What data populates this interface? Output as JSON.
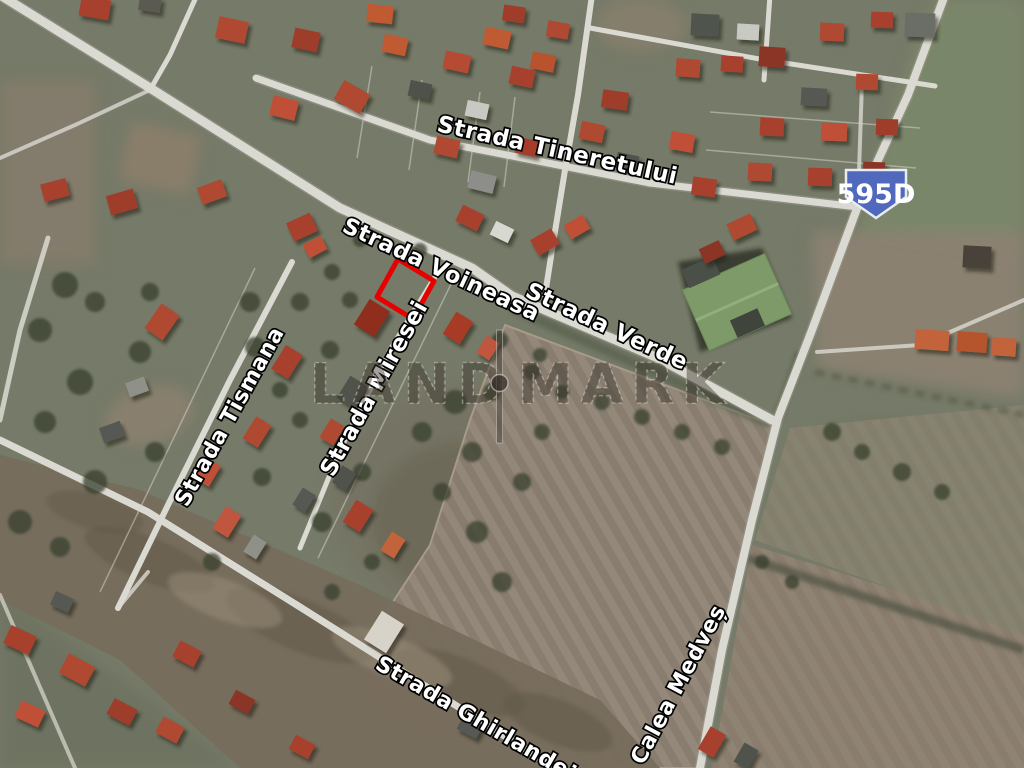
{
  "image": {
    "kind": "satellite-aerial-photo",
    "width": 1024,
    "height": 768
  },
  "watermark": {
    "left": "LAND",
    "right": "MARK",
    "divider": "bar-dot-separator"
  },
  "road_badge": {
    "label": "595D",
    "fill": "#5069bd"
  },
  "plot_marker": {
    "shape": "rotated-rectangle",
    "color": "#e60000"
  },
  "street_labels": [
    {
      "id": "tineretului",
      "text": "Strada Tineretului",
      "x": 436,
      "y": 131,
      "rot": 12.5,
      "size": 23
    },
    {
      "id": "voineasa",
      "text": "Strada Voineasa",
      "x": 341,
      "y": 231,
      "rot": 25,
      "size": 22.5
    },
    {
      "id": "verde",
      "text": "Strada Verde",
      "x": 524,
      "y": 296,
      "rot": 25,
      "size": 23
    },
    {
      "id": "tismana",
      "text": "Strada Tismana",
      "x": 187,
      "y": 508,
      "rot": -61,
      "size": 22
    },
    {
      "id": "miresei",
      "text": "Strada Miresei",
      "x": 333,
      "y": 478,
      "rot": -61,
      "size": 23
    },
    {
      "id": "ghirlandei",
      "text": "Strada Ghirlandei",
      "x": 374,
      "y": 668,
      "rot": 30,
      "size": 22
    },
    {
      "id": "calea-medves",
      "text": "Calea Medveș",
      "x": 643,
      "y": 766,
      "rot": -62,
      "size": 22
    }
  ],
  "colors": {
    "terrain": "#767a68",
    "road": "#dbdad2",
    "road_edge": "#9c9c90",
    "field": "#8e8276",
    "field_stripe": "#958a7c",
    "scrub": "#776d5d",
    "roof_red": "#a8412e",
    "roof_orange": "#c2633a",
    "roof_dark": "#4f524c",
    "warehouse_green": "#7e9a68",
    "label_text": "#ffffff",
    "plot_outline": "#e60000",
    "badge_blue": "#5069bd"
  },
  "houses": [
    [
      95,
      8,
      30,
      20,
      10,
      "#a8412e"
    ],
    [
      150,
      4,
      22,
      15,
      8,
      "#5a5a52"
    ],
    [
      232,
      30,
      30,
      22,
      12,
      "#b04a30"
    ],
    [
      306,
      40,
      26,
      20,
      12,
      "#9e3d2a"
    ],
    [
      380,
      14,
      26,
      18,
      6,
      "#c05a33"
    ],
    [
      352,
      97,
      30,
      22,
      30,
      "#b04a30"
    ],
    [
      284,
      108,
      26,
      20,
      14,
      "#c05038"
    ],
    [
      420,
      90,
      22,
      16,
      12,
      "#50514b"
    ],
    [
      457,
      62,
      26,
      18,
      12,
      "#b44c32"
    ],
    [
      522,
      77,
      24,
      18,
      12,
      "#a8412e"
    ],
    [
      477,
      110,
      22,
      16,
      12,
      "#c9c9c3"
    ],
    [
      447,
      147,
      24,
      18,
      13,
      "#b04a30"
    ],
    [
      482,
      182,
      26,
      18,
      14,
      "#8d8d89"
    ],
    [
      527,
      147,
      22,
      16,
      13,
      "#a63d2b"
    ],
    [
      558,
      30,
      22,
      16,
      10,
      "#b04a30"
    ],
    [
      497,
      38,
      26,
      18,
      12,
      "#c05a33"
    ],
    [
      543,
      62,
      24,
      17,
      12,
      "#b8522e"
    ],
    [
      395,
      45,
      24,
      18,
      12,
      "#c05a33"
    ],
    [
      514,
      14,
      22,
      16,
      8,
      "#9e3d2a"
    ],
    [
      705,
      25,
      28,
      22,
      3,
      "#50544e"
    ],
    [
      748,
      32,
      22,
      16,
      3,
      "#c9c9c3"
    ],
    [
      688,
      68,
      24,
      18,
      4,
      "#b04a30"
    ],
    [
      732,
      64,
      22,
      16,
      4,
      "#a8412e"
    ],
    [
      772,
      57,
      26,
      20,
      4,
      "#8a3526"
    ],
    [
      832,
      32,
      24,
      18,
      3,
      "#b04a30"
    ],
    [
      882,
      20,
      22,
      16,
      2,
      "#a8412e"
    ],
    [
      920,
      25,
      30,
      24,
      2,
      "#6a6e66"
    ],
    [
      814,
      97,
      26,
      18,
      3,
      "#565852"
    ],
    [
      867,
      82,
      22,
      16,
      2,
      "#b04a30"
    ],
    [
      772,
      127,
      24,
      18,
      3,
      "#a8412e"
    ],
    [
      834,
      132,
      26,
      18,
      2,
      "#c05038"
    ],
    [
      887,
      127,
      22,
      16,
      2,
      "#9e3d2a"
    ],
    [
      760,
      172,
      24,
      18,
      3,
      "#b04a30"
    ],
    [
      820,
      177,
      24,
      18,
      2,
      "#a8412e"
    ],
    [
      874,
      170,
      22,
      16,
      2,
      "#8a3526"
    ],
    [
      592,
      132,
      24,
      18,
      12,
      "#b04a30"
    ],
    [
      627,
      162,
      22,
      16,
      12,
      "#4f524c"
    ],
    [
      682,
      142,
      24,
      18,
      10,
      "#c05038"
    ],
    [
      704,
      187,
      24,
      18,
      8,
      "#a8412e"
    ],
    [
      615,
      100,
      26,
      18,
      8,
      "#9e3d2a"
    ],
    [
      55,
      190,
      26,
      18,
      -15,
      "#a8412e"
    ],
    [
      122,
      202,
      28,
      20,
      -16,
      "#9e3d2a"
    ],
    [
      212,
      192,
      26,
      18,
      -20,
      "#b04a30"
    ],
    [
      302,
      227,
      26,
      20,
      -25,
      "#a8412e"
    ],
    [
      315,
      247,
      20,
      15,
      -28,
      "#c05038"
    ],
    [
      162,
      322,
      30,
      22,
      -55,
      "#b04a30"
    ],
    [
      287,
      362,
      28,
      20,
      -58,
      "#a8412e"
    ],
    [
      207,
      472,
      24,
      18,
      -60,
      "#c05038"
    ],
    [
      112,
      432,
      22,
      16,
      -20,
      "#565852"
    ],
    [
      137,
      387,
      20,
      15,
      -20,
      "#8f9189"
    ],
    [
      257,
      432,
      26,
      18,
      -58,
      "#b04a30"
    ],
    [
      227,
      522,
      26,
      18,
      -58,
      "#c0563d"
    ],
    [
      304,
      500,
      20,
      15,
      -58,
      "#565852"
    ],
    [
      255,
      547,
      20,
      15,
      -58,
      "#8f9189"
    ],
    [
      372,
      318,
      30,
      24,
      -58,
      "#8f2d1d"
    ],
    [
      458,
      328,
      26,
      20,
      -58,
      "#a83b28"
    ],
    [
      488,
      348,
      20,
      15,
      -58,
      "#c0563d"
    ],
    [
      352,
      392,
      26,
      20,
      -58,
      "#4f524c"
    ],
    [
      332,
      432,
      22,
      16,
      -58,
      "#b04a30"
    ],
    [
      358,
      516,
      26,
      20,
      -58,
      "#a8412e"
    ],
    [
      393,
      545,
      22,
      16,
      -58,
      "#c2633a"
    ],
    [
      344,
      478,
      20,
      16,
      -58,
      "#4f524c"
    ],
    [
      470,
      218,
      24,
      18,
      26,
      "#a8412e"
    ],
    [
      502,
      232,
      20,
      15,
      26,
      "#d8d8d2"
    ],
    [
      545,
      242,
      24,
      18,
      -30,
      "#a8412e"
    ],
    [
      577,
      227,
      22,
      16,
      -30,
      "#c05038"
    ],
    [
      742,
      227,
      26,
      18,
      -25,
      "#b04a30"
    ],
    [
      712,
      252,
      22,
      16,
      -25,
      "#8a3526"
    ],
    [
      932,
      340,
      34,
      20,
      4,
      "#c2633a"
    ],
    [
      972,
      342,
      30,
      20,
      4,
      "#b5552f"
    ],
    [
      1004,
      347,
      24,
      18,
      4,
      "#c2633a"
    ],
    [
      977,
      257,
      28,
      22,
      3,
      "#4a423a"
    ],
    [
      20,
      640,
      28,
      20,
      25,
      "#a8412e"
    ],
    [
      77,
      670,
      30,
      22,
      28,
      "#b04a30"
    ],
    [
      30,
      714,
      26,
      18,
      25,
      "#c05038"
    ],
    [
      122,
      712,
      26,
      18,
      28,
      "#9e3d2a"
    ],
    [
      187,
      654,
      24,
      18,
      28,
      "#a8412e"
    ],
    [
      170,
      730,
      24,
      18,
      28,
      "#b04a30"
    ],
    [
      242,
      702,
      22,
      16,
      28,
      "#8a3526"
    ],
    [
      302,
      747,
      22,
      16,
      28,
      "#a8412e"
    ],
    [
      62,
      602,
      20,
      15,
      25,
      "#565852"
    ],
    [
      712,
      742,
      26,
      18,
      -60,
      "#a8412e"
    ],
    [
      746,
      756,
      22,
      16,
      -60,
      "#4f524c"
    ],
    [
      384,
      632,
      34,
      26,
      -58,
      "#d8d3c8"
    ],
    [
      470,
      727,
      22,
      16,
      28,
      "#565852"
    ]
  ],
  "bushes": [
    [
      65,
      285,
      13
    ],
    [
      95,
      302,
      10
    ],
    [
      40,
      330,
      12
    ],
    [
      150,
      292,
      9
    ],
    [
      250,
      302,
      10
    ],
    [
      332,
      272,
      8
    ],
    [
      300,
      302,
      9
    ],
    [
      255,
      347,
      10
    ],
    [
      140,
      352,
      11
    ],
    [
      80,
      382,
      13
    ],
    [
      45,
      422,
      11
    ],
    [
      155,
      452,
      10
    ],
    [
      95,
      482,
      12
    ],
    [
      262,
      477,
      9
    ],
    [
      322,
      522,
      10
    ],
    [
      362,
      472,
      9
    ],
    [
      422,
      432,
      10
    ],
    [
      455,
      402,
      12
    ],
    [
      472,
      452,
      10
    ],
    [
      442,
      492,
      9
    ],
    [
      477,
      532,
      11
    ],
    [
      502,
      582,
      10
    ],
    [
      522,
      482,
      9
    ],
    [
      542,
      432,
      8
    ],
    [
      492,
      392,
      9
    ],
    [
      532,
      372,
      8
    ],
    [
      562,
      392,
      7
    ],
    [
      602,
      402,
      8
    ],
    [
      642,
      417,
      8
    ],
    [
      682,
      432,
      8
    ],
    [
      722,
      447,
      8
    ],
    [
      20,
      522,
      12
    ],
    [
      60,
      547,
      10
    ],
    [
      212,
      562,
      9
    ],
    [
      332,
      592,
      8
    ],
    [
      372,
      562,
      8
    ],
    [
      832,
      432,
      9
    ],
    [
      862,
      452,
      8
    ],
    [
      902,
      472,
      9
    ],
    [
      942,
      492,
      8
    ],
    [
      762,
      562,
      7
    ],
    [
      792,
      582,
      7
    ],
    [
      350,
      300,
      8
    ],
    [
      420,
      250,
      7
    ],
    [
      500,
      340,
      8
    ],
    [
      540,
      355,
      7
    ],
    [
      360,
      240,
      7
    ],
    [
      330,
      350,
      9
    ],
    [
      300,
      420,
      8
    ],
    [
      280,
      390,
      8
    ]
  ]
}
